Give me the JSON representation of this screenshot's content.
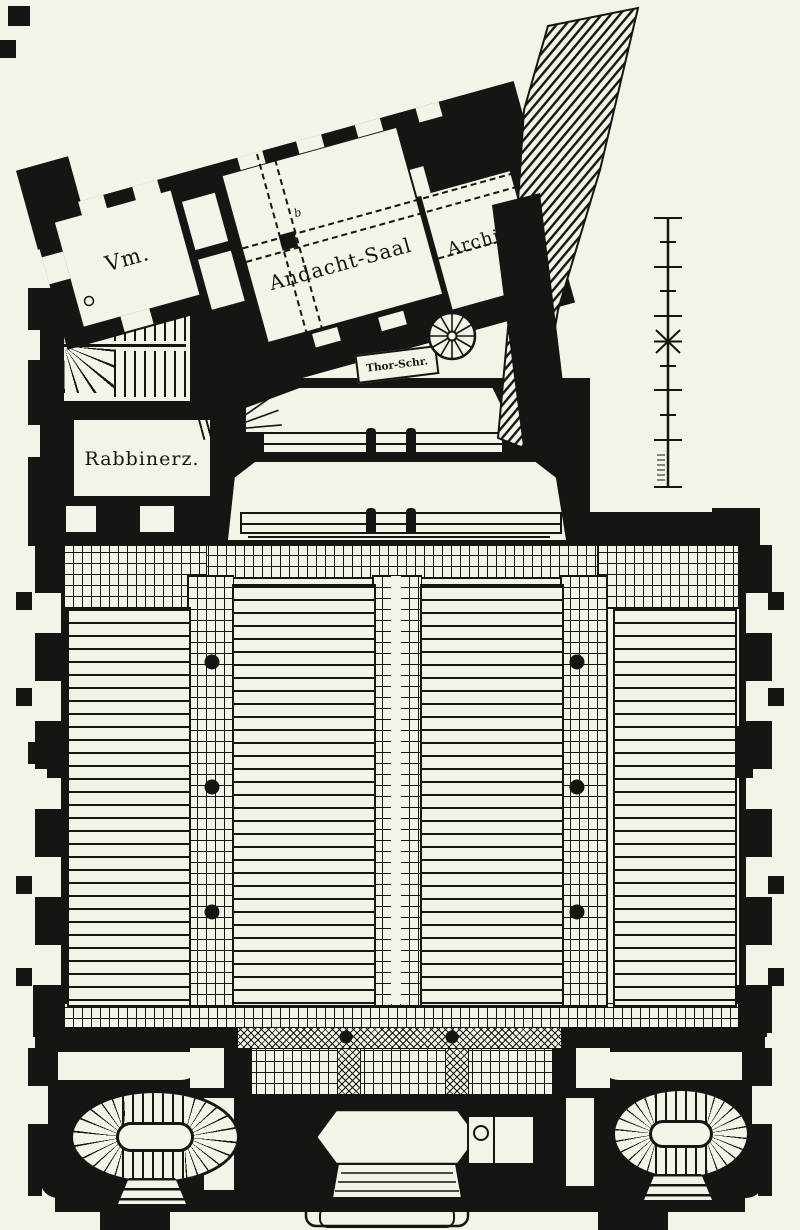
{
  "colors": {
    "paper": "#f5f2ea",
    "ink": "#171412"
  },
  "rooms": {
    "vm": {
      "label": "Vm."
    },
    "andacht_saal": {
      "label": "Andacht-Saal"
    },
    "archiv": {
      "label": "Archiv."
    },
    "rabbinerz": {
      "label": "Rabbinerz."
    },
    "thor_shrine": {
      "label": "Thor-Schr."
    }
  },
  "annotations": {
    "axis_marker": "b"
  }
}
